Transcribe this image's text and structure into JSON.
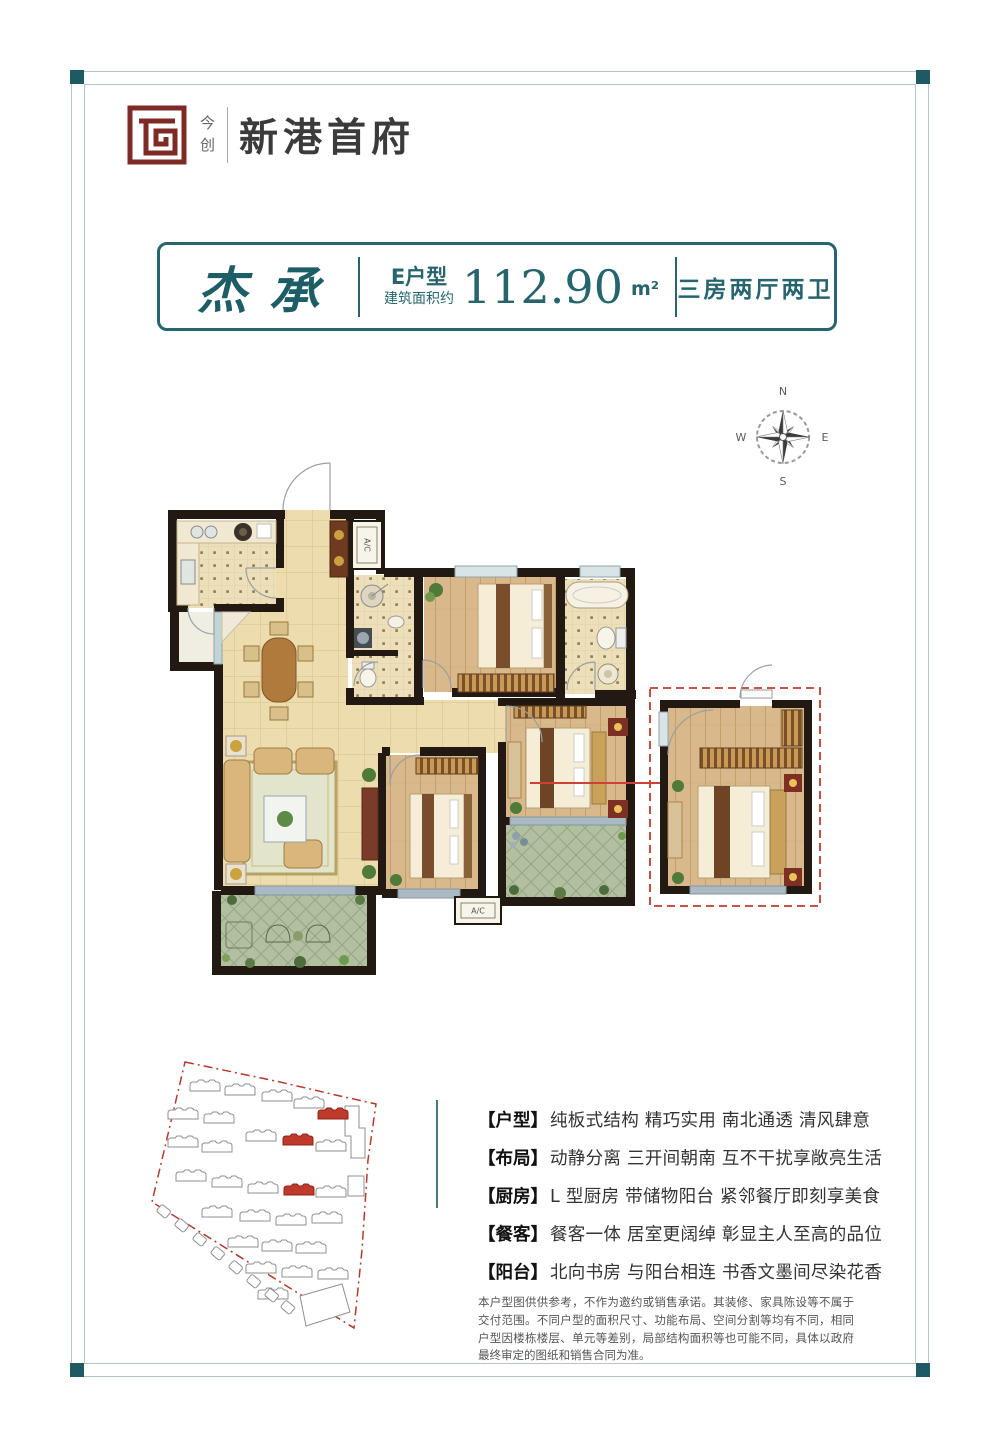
{
  "colors": {
    "teal": "#26656e",
    "maroon": "#7d2b24",
    "red": "#c23b2e",
    "wall": "#221a12"
  },
  "header": {
    "brand_side": "今创",
    "brand_name": "新港首府"
  },
  "title_box": {
    "calligraphy": "杰承",
    "unit_label": "E户型",
    "area_prefix": "建筑面积约",
    "area_value": "112.90",
    "area_unit": "m²",
    "layout_text": "三房两厅两卫"
  },
  "compass": {
    "n": "N",
    "e": "E",
    "s": "S",
    "w": "W"
  },
  "floor_plan": {
    "ac_label": "A/C"
  },
  "features": [
    {
      "label": "【户型】",
      "text": "纯板式结构 精巧实用 南北通透 清风肆意"
    },
    {
      "label": "【布局】",
      "text": "动静分离 三开间朝南 互不干扰享敞亮生活"
    },
    {
      "label": "【厨房】",
      "text": "L 型厨房 带储物阳台 紧邻餐厅即刻享美食"
    },
    {
      "label": "【餐客】",
      "text": "餐客一体 居室更阔绰 彰显主人至高的品位"
    },
    {
      "label": "【阳台】",
      "text": "北向书房 与阳台相连 书香文墨间尽染花香"
    }
  ],
  "disclaimer": "本户型图供供参考，不作为邀约或销售承诺。其装修、家具陈设等不属于交付范围。不同户型的面积尺寸、功能布局、空间分割等均有不同，相同户型因楼栋楼层、单元等差别，局部结构面积等也可能不同，具体以政府最终审定的图纸和销售合同为准。"
}
